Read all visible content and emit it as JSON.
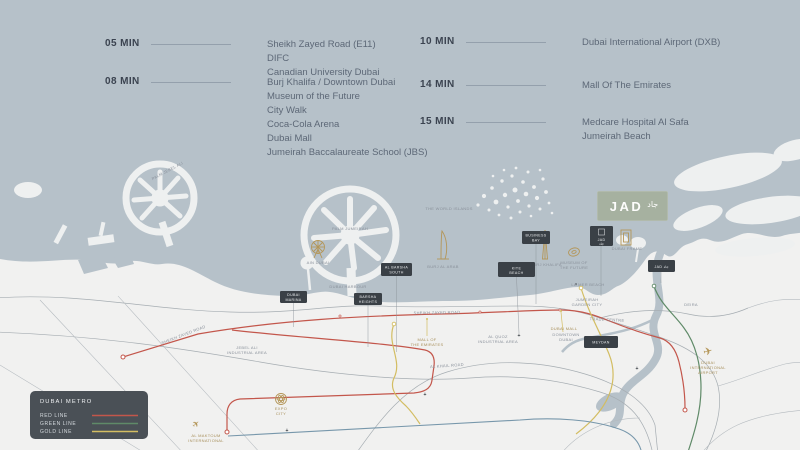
{
  "header": {
    "left": [
      {
        "time": "05 MIN",
        "places": [
          "Sheikh Zayed Road (E11)",
          "DIFC",
          "Canadian University Dubai"
        ]
      },
      {
        "time": "08 MIN",
        "places": [
          "Burj Khalifa / Downtown Dubai",
          "Museum of the Future",
          "City Walk",
          "Coca-Cola Arena",
          "Dubai Mall",
          "Jumeirah Baccalaureate School (JBS)"
        ]
      }
    ],
    "right": [
      {
        "time": "10 MIN",
        "places": [
          "Dubai International Airport (DXB)"
        ]
      },
      {
        "time": "14 MIN",
        "places": [
          "Mall Of The Emirates"
        ]
      },
      {
        "time": "15 MIN",
        "places": [
          "Medcare Hospital Al Safa",
          "Jumeirah Beach"
        ]
      }
    ]
  },
  "logo": {
    "text": "JAD",
    "mark": "جاد"
  },
  "map": {
    "labels": [
      {
        "text": "PALM JEBEL ALI"
      },
      {
        "text": "PALM JUMEIRAH"
      },
      {
        "text": "THE WORLD ISLANDS"
      },
      {
        "text": "DUBAI HARBOUR"
      },
      {
        "text": "AIN DUBAI"
      },
      {
        "text": "BURJ AL ARAB"
      },
      {
        "text": "BURJ KHALIFA"
      },
      {
        "text": "MUSEUM OF"
      },
      {
        "text": "THE FUTURE"
      },
      {
        "text": "DUBAI FRAME"
      },
      {
        "text": "LA MER BEACH"
      },
      {
        "text": "JUMEIRAH"
      },
      {
        "text": "GARDEN CITY"
      },
      {
        "text": "TRADE CENTRE"
      },
      {
        "text": "DEIRA"
      },
      {
        "text": "SHEIKH ZAYED ROAD"
      },
      {
        "text": "SHEIKH ZAYED ROAD"
      },
      {
        "text": "JEBEL ALI"
      },
      {
        "text": "INDUSTRIAL AREA"
      },
      {
        "text": "AL QUOZ"
      },
      {
        "text": "INDUSTRIAL AREA"
      },
      {
        "text": "AL KHAIL ROAD"
      },
      {
        "text": "DOWNTOWN"
      },
      {
        "text": "DUBAI"
      },
      {
        "text": "DUBAI MALL"
      },
      {
        "text": "MALL OF"
      },
      {
        "text": "THE EMIRATES"
      },
      {
        "text": "EXPO"
      },
      {
        "text": "CITY"
      },
      {
        "text": "AL MAKTOUM"
      },
      {
        "text": "INTERNATIONAL"
      },
      {
        "text": "DUBAI"
      },
      {
        "text": "INTERNATIONAL"
      },
      {
        "text": "AIRPORT"
      }
    ],
    "callouts": [
      {
        "line1": "DUBAI",
        "line2": "MARINA"
      },
      {
        "line1": "BARSHA",
        "line2": "HEIGHTS"
      },
      {
        "line1": "AL BARSHA",
        "line2": "SOUTH"
      },
      {
        "line1": "BUSINESS",
        "line2": "BAY"
      },
      {
        "line1": "MEYDAN",
        "line2": ""
      },
      {
        "line1": "JAD جاد",
        "line2": ""
      },
      {
        "line1": "JAD",
        "line2": "جاد"
      },
      {
        "line1": "KITE",
        "line2": "BEACH"
      }
    ],
    "legend": {
      "title": "DUBAI METRO",
      "items": [
        {
          "label": "RED LINE",
          "color": "#c3564b"
        },
        {
          "label": "GREEN LINE",
          "color": "#5f8a68"
        },
        {
          "label": "GOLD LINE",
          "color": "#d3bd62"
        }
      ]
    },
    "colors": {
      "sea": "#b6c1c9",
      "land": "#f1f1f0",
      "gold_accent": "#b49658",
      "callout_bg": "#3a4046"
    }
  }
}
